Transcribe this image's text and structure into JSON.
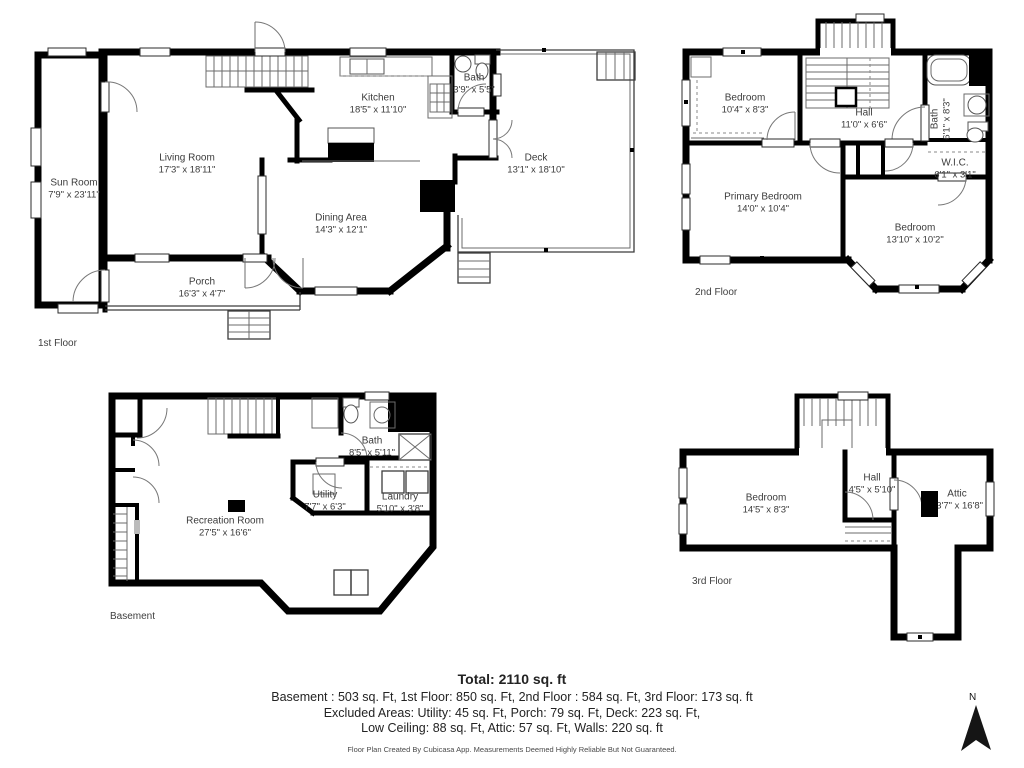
{
  "colors": {
    "wall": "#000000",
    "label_text": "#3b3b3b",
    "summary_text": "#232323"
  },
  "floors": {
    "first": {
      "caption": "1st Floor",
      "rooms": {
        "sunroom": {
          "name": "Sun Room",
          "dims": "7'9\" x 23'11\""
        },
        "living": {
          "name": "Living Room",
          "dims": "17'3\" x 18'11\""
        },
        "kitchen": {
          "name": "Kitchen",
          "dims": "18'5\" x 11'10\""
        },
        "bath": {
          "name": "Bath",
          "dims": "3'9\" x 5'5\""
        },
        "deck": {
          "name": "Deck",
          "dims": "13'1\" x 18'10\""
        },
        "dining": {
          "name": "Dining Area",
          "dims": "14'3\" x 12'1\""
        },
        "porch": {
          "name": "Porch",
          "dims": "16'3\" x 4'7\""
        }
      }
    },
    "second": {
      "caption": "2nd Floor",
      "rooms": {
        "bedroom1": {
          "name": "Bedroom",
          "dims": "10'4\" x 8'3\""
        },
        "hall": {
          "name": "Hall",
          "dims": "11'0\" x 6'6\""
        },
        "bath": {
          "name": "Bath",
          "dims": "6'1\" x 8'3\""
        },
        "wic": {
          "name": "W.I.C.",
          "dims": "6'1\" x 3'1\""
        },
        "primary": {
          "name": "Primary Bedroom",
          "dims": "14'0\" x 10'4\""
        },
        "bedroom2": {
          "name": "Bedroom",
          "dims": "13'10\" x 10'2\""
        }
      }
    },
    "basement": {
      "caption": "Basement",
      "rooms": {
        "bath": {
          "name": "Bath",
          "dims": "8'5\" x 5'11\""
        },
        "utility": {
          "name": "Utility",
          "dims": "7'7\" x 6'3\""
        },
        "laundry": {
          "name": "Laundry",
          "dims": "5'10\" x 3'8\""
        },
        "rec": {
          "name": "Recreation Room",
          "dims": "27'5\" x 16'6\""
        }
      }
    },
    "third": {
      "caption": "3rd Floor",
      "rooms": {
        "bedroom": {
          "name": "Bedroom",
          "dims": "14'5\" x 8'3\""
        },
        "hall": {
          "name": "Hall",
          "dims": "4'5\" x 5'10\""
        },
        "attic": {
          "name": "Attic",
          "dims": "13'7\" x 16'8\""
        }
      }
    }
  },
  "summary": {
    "total": "Total: 2110 sq. ft",
    "floors_line": "Basement : 503 sq. Ft, 1st Floor: 850 sq. Ft, 2nd Floor : 584 sq. Ft, 3rd Floor: 173 sq. ft",
    "excluded_line1": "Excluded Areas: Utility: 45 sq. Ft, Porch: 79 sq. Ft, Deck: 223 sq. Ft,",
    "excluded_line2": "Low Ceiling: 88 sq. Ft, Attic: 57 sq. Ft, Walls: 220 sq. ft",
    "credit": "Floor Plan Created By Cubicasa App. Measurements Deemed Highly Reliable But Not Guaranteed."
  },
  "compass": {
    "label": "N"
  }
}
